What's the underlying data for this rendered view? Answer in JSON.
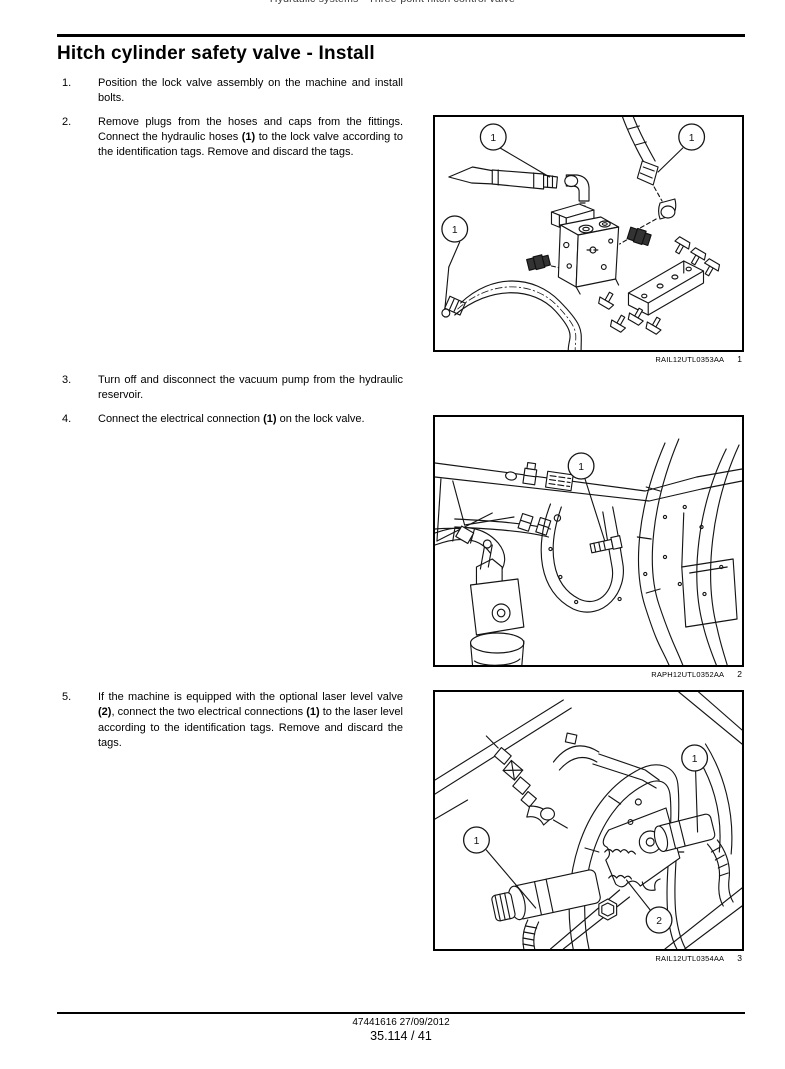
{
  "page": {
    "running_header": "Hydraulic systems - Three-point hitch control valve",
    "title": "Hitch cylinder safety valve - Install",
    "footer": {
      "doc_line": "47441616 27/09/2012",
      "page_line": "35.114 / 41"
    }
  },
  "steps": [
    {
      "group": 0,
      "number": "1.",
      "segments": [
        {
          "text": "Position the lock valve assembly on the machine and install bolts.",
          "bold": false
        }
      ]
    },
    {
      "group": 0,
      "number": "2.",
      "segments": [
        {
          "text": "Remove plugs from the hoses and caps from the fittings.  Connect the hydraulic hoses ",
          "bold": false
        },
        {
          "text": "(1)",
          "bold": true
        },
        {
          "text": " to the lock valve according to the identification tags.  Remove and discard the tags.",
          "bold": false
        }
      ]
    },
    {
      "group": 1,
      "number": "3.",
      "segments": [
        {
          "text": "Turn off and disconnect the vacuum pump from the hydraulic reservoir.",
          "bold": false
        }
      ]
    },
    {
      "group": 1,
      "number": "4.",
      "segments": [
        {
          "text": "Connect the electrical connection ",
          "bold": false
        },
        {
          "text": "(1)",
          "bold": true
        },
        {
          "text": " on the lock valve.",
          "bold": false
        }
      ]
    },
    {
      "group": 2,
      "number": "5.",
      "segments": [
        {
          "text": "If the machine is equipped with the optional laser level valve ",
          "bold": false
        },
        {
          "text": "(2)",
          "bold": true
        },
        {
          "text": ", connect the two electrical connections ",
          "bold": false
        },
        {
          "text": "(1)",
          "bold": true
        },
        {
          "text": " to the laser level according to the identification tags.  Remove and discard the tags.",
          "bold": false
        }
      ]
    }
  ],
  "figures": [
    {
      "code": "RAIL12UTL0353AA",
      "number": "1",
      "callouts": [
        "1",
        "1",
        "1"
      ]
    },
    {
      "code": "RAPH12UTL0352AA",
      "number": "2",
      "callouts": [
        "1"
      ]
    },
    {
      "code": "RAIL12UTL0354AA",
      "number": "3",
      "callouts": [
        "1",
        "1",
        "2"
      ]
    }
  ]
}
